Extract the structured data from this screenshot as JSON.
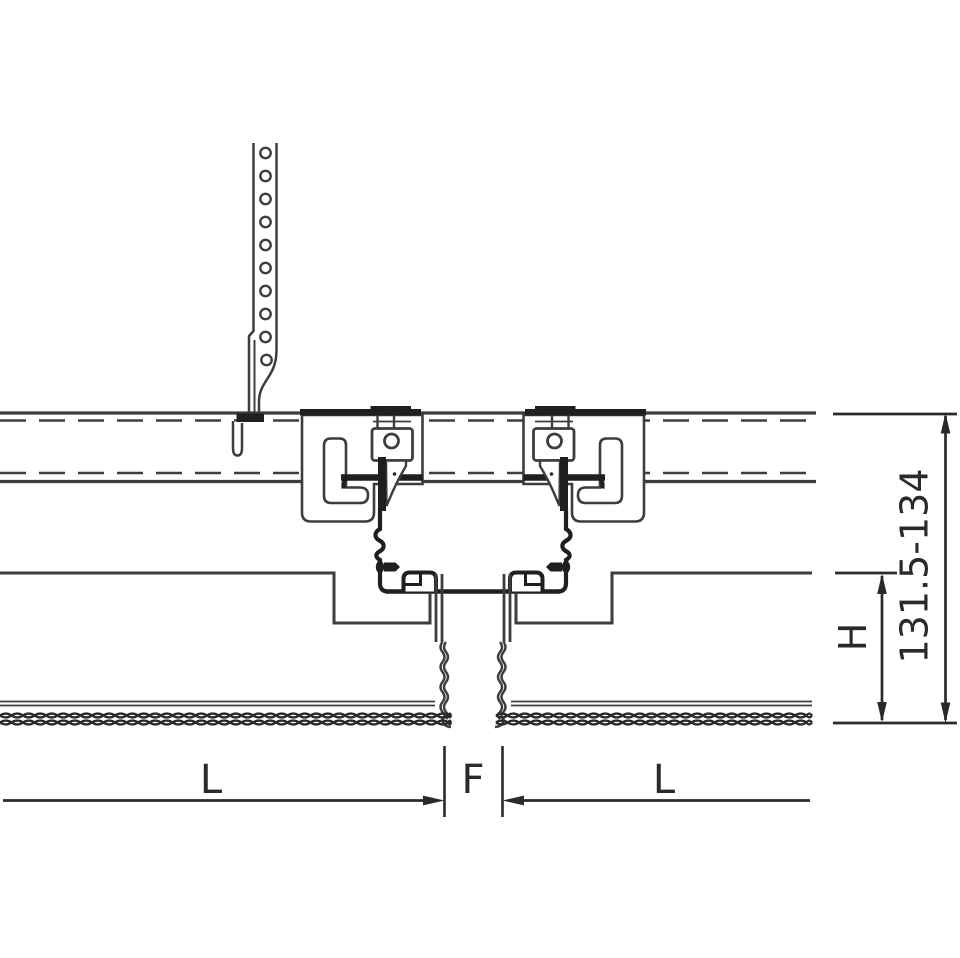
{
  "diagram": {
    "labels": {
      "height_range": "131.5-134",
      "panel_height": "H",
      "module_left": "L",
      "joint_gap": "F",
      "module_right": "L"
    }
  },
  "colors": {
    "background": "#ffffff",
    "line": "#3d3d3d",
    "heavy": "#1f1f1f",
    "dimension": "#2a2a2a"
  }
}
